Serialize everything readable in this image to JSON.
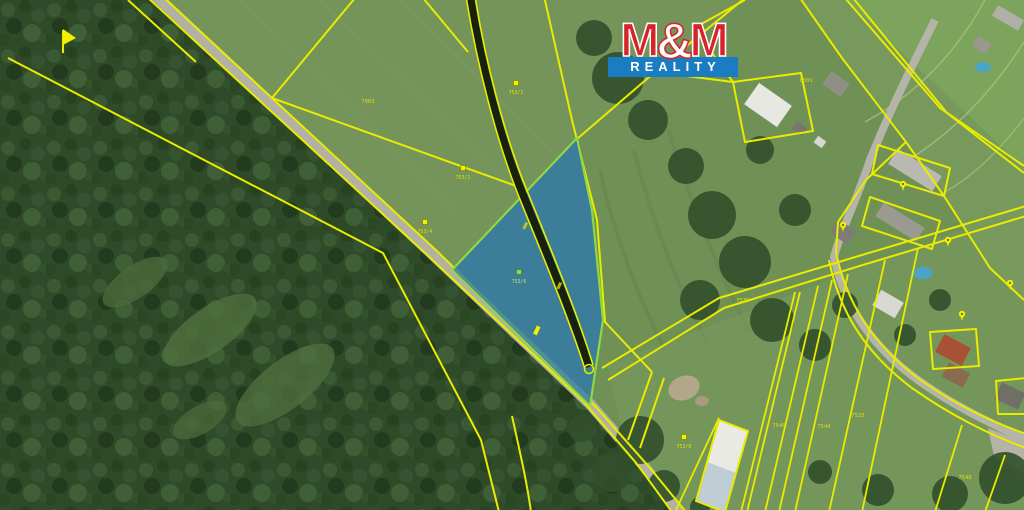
{
  "logo": {
    "m_left": "M",
    "ampersand": "&",
    "m_right": "M",
    "word": "REALITY",
    "red": "#d8232a",
    "blue": "#1a7cc1"
  },
  "map": {
    "type": "aerial-cadastral-map",
    "highlight": {
      "fill": "#2e78ad",
      "stroke": "#8fd743",
      "opacity": "0.78"
    },
    "cadastral_line_color": "#e9eb00",
    "label_color": "#e3e000",
    "road_color": "#b2b1a4",
    "parcel_labels": [
      {
        "text": "7963"
      },
      {
        "text": "8001"
      },
      {
        "text": "7535"
      },
      {
        "text": "7540"
      },
      {
        "text": "7544"
      },
      {
        "text": "7533"
      },
      {
        "text": "7548"
      }
    ],
    "markers": [
      {
        "label": "753/1"
      },
      {
        "label": "753/2"
      },
      {
        "label": "753/4"
      },
      {
        "label": "753/6"
      },
      {
        "label": "753/8"
      }
    ]
  }
}
